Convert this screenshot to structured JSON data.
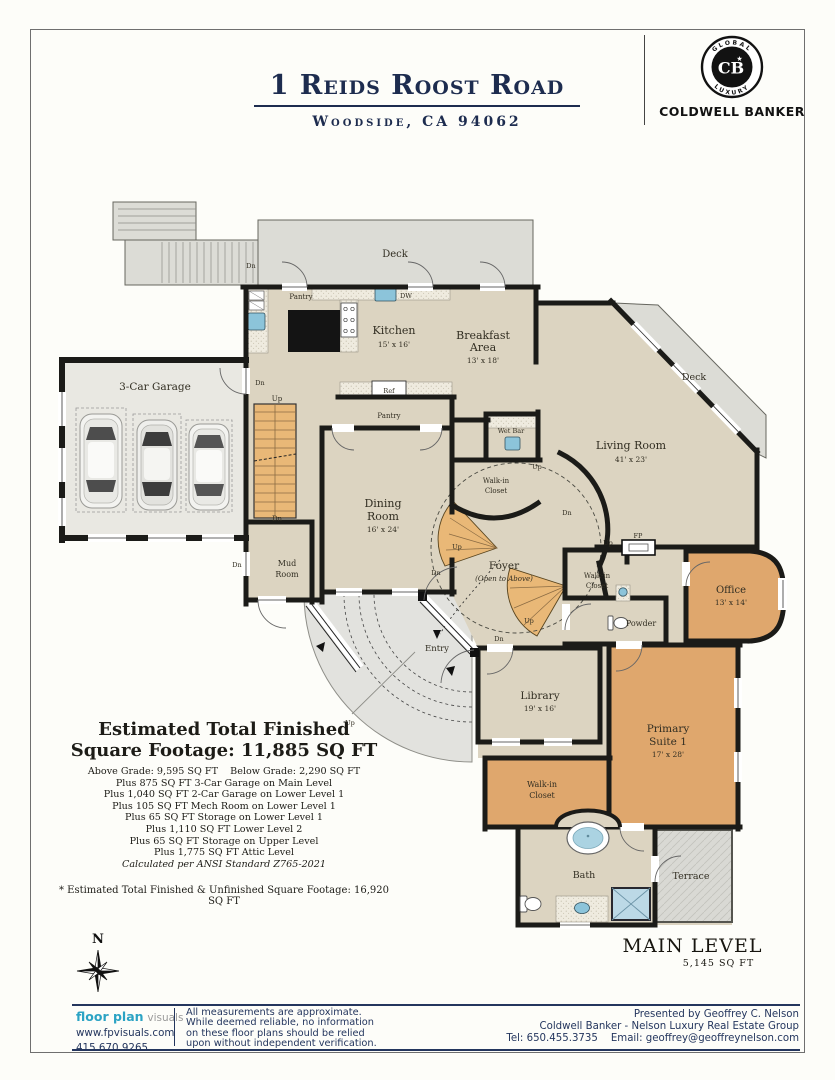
{
  "header": {
    "address": "1 Reids Roost Road",
    "city": "Woodside, CA 94062"
  },
  "brand": {
    "arc_top": "GLOBAL",
    "arc_bottom": "LUXURY",
    "monogram": "CB",
    "star": "★",
    "name": "COLDWELL BANKER"
  },
  "estimate": {
    "heading_line1": "Estimated Total Finished",
    "heading_line2": "Square Footage: 11,885 SQ FT",
    "lines": [
      "Above Grade: 9,595 SQ FT    Below Grade: 2,290 SQ FT",
      "Plus 875 SQ FT 3-Car Garage on Main Level",
      "Plus 1,040 SQ FT 2-Car Garage on Lower Level 1",
      "Plus 105 SQ FT Mech Room on Lower Level 1",
      "Plus 65 SQ FT Storage on Lower Level 1",
      "Plus 1,110 SQ FT Lower Level 2",
      "Plus 65 SQ FT Storage on Upper Level",
      "Plus 1,775 SQ FT Attic Level"
    ],
    "ansi_note": "Calculated per ANSI Standard Z765-2021",
    "footnote": "* Estimated Total Finished & Unfinished Square Footage: 16,920 SQ FT"
  },
  "level": {
    "name": "MAIN LEVEL",
    "sqft": "5,145 SQ FT"
  },
  "compass": {
    "north": "N"
  },
  "rooms": {
    "deck": "Deck",
    "garage": "3-Car Garage",
    "kitchen": {
      "name": "Kitchen",
      "dims": "15' x 16'"
    },
    "breakfast": {
      "l1": "Breakfast",
      "l2": "Area",
      "dims": "13' x 18'"
    },
    "living": {
      "name": "Living Room",
      "dims": "41' x 23'"
    },
    "dining": {
      "l1": "Dining",
      "l2": "Room",
      "dims": "16' x 24'"
    },
    "pantry": "Pantry",
    "mud": {
      "l1": "Mud",
      "l2": "Room"
    },
    "wet_bar": "Wet Bar",
    "walk_in": {
      "l1": "Walk-in",
      "l2": "Closet"
    },
    "foyer": {
      "name": "Foyer",
      "note": "(Open to Above)"
    },
    "entry": "Entry",
    "library": {
      "name": "Library",
      "dims": "19' x 16'"
    },
    "office": {
      "name": "Office",
      "dims": "13' x 14'"
    },
    "powder": "Powder",
    "primary": {
      "l1": "Primary",
      "l2": "Suite 1",
      "dims": "17' x 28'"
    },
    "bath": "Bath",
    "terrace": "Terrace"
  },
  "fixtures": {
    "dw": "DW",
    "ref": "Ref",
    "fp": "FP"
  },
  "stairs": {
    "up": "Up",
    "dn": "Dn"
  },
  "footer": {
    "logo_bold": "floor plan",
    "logo_light": "visuals",
    "website": "www.fpvisuals.com",
    "phone": "415.670.9265",
    "disclaimer": [
      "All measurements are approximate.",
      "While deemed reliable, no information",
      "on these floor plans should be relied",
      "upon without independent verification."
    ],
    "presented": [
      "Presented by Geoffrey C. Nelson",
      "Coldwell Banker - Nelson Luxury Real Estate Group",
      "Tel: 650.455.3735    Email: geoffrey@geoffreynelson.com"
    ]
  },
  "colors": {
    "navy": "#1d2c4f",
    "footer_navy": "#24365e",
    "logo_cyan": "#2ba3c4",
    "floor_beige": "#dcd4c1",
    "wood_orange": "#dfa76d",
    "stair_orange": "#e9b877",
    "deck_gray": "#dcdcd6",
    "water_blue": "#8cc4da",
    "wall_black": "#1b1b18"
  }
}
